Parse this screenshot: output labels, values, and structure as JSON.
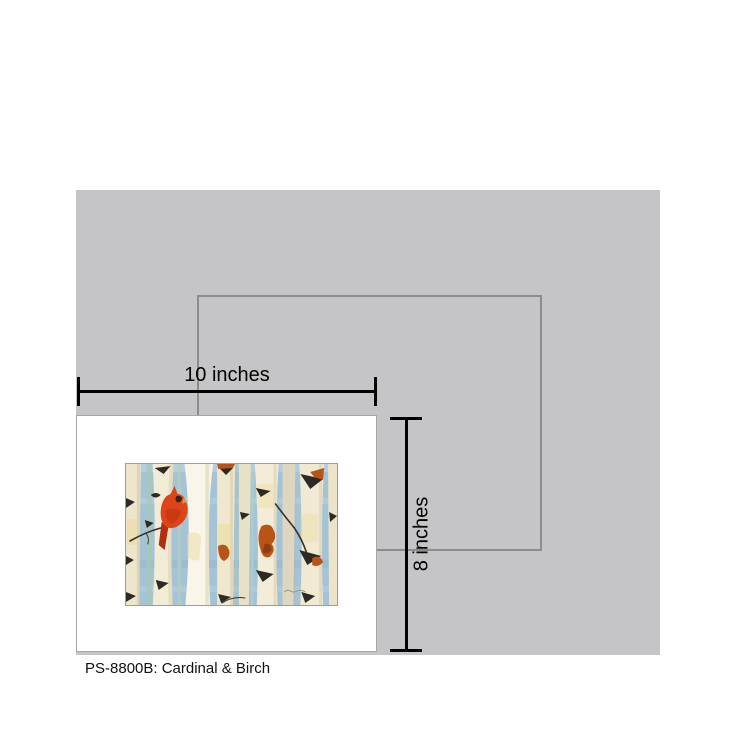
{
  "colors": {
    "wall-gray": "#c5c4c6",
    "outline-gray": "#8c8c8c",
    "dimension-black": "#000000",
    "card-white": "#ffffff",
    "sky-blue": "#a5c3d7",
    "birch-cream": "#f2ebd6",
    "birch-bright": "#f9f5e8",
    "bark-dark": "#2d2a23",
    "rust-orange": "#b85417",
    "cardinal-red": "#dd4418"
  },
  "mockup": {
    "width_label": "10 inches",
    "height_label": "8 inches",
    "caption": "PS-8800B: Cardinal & Birch",
    "artwork_title": "Cardinal & Birch"
  }
}
